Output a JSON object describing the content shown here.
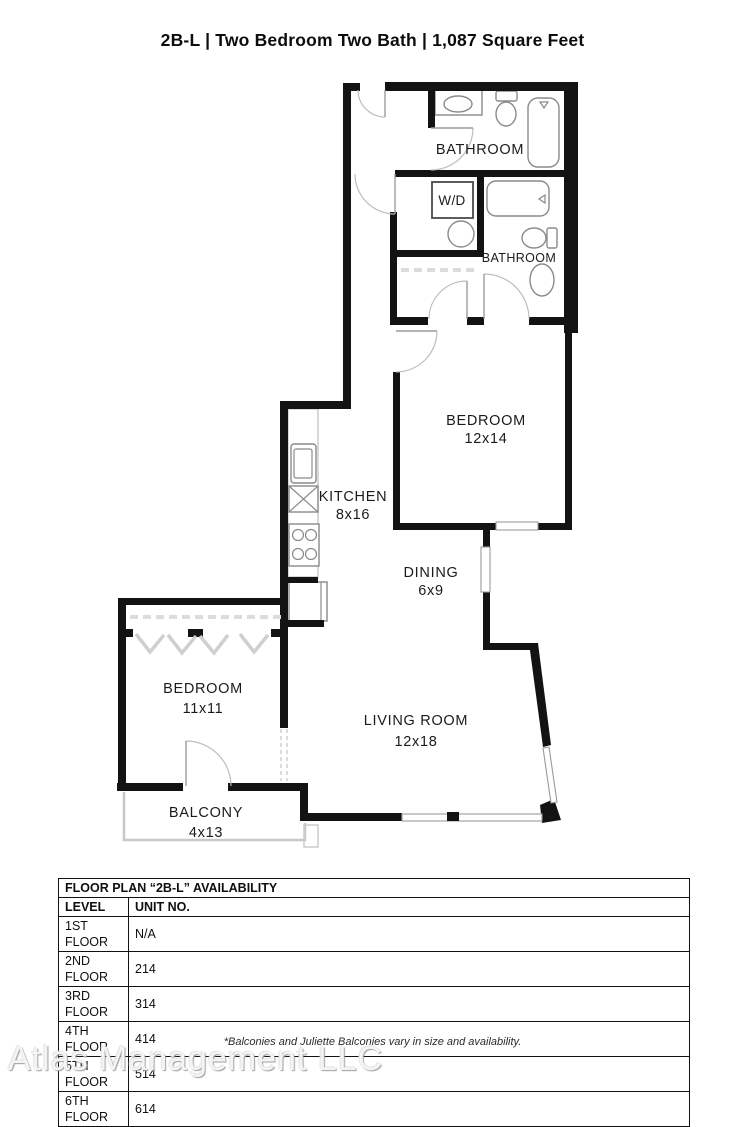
{
  "page": {
    "title": "2B-L | Two Bedroom Two Bath | 1,087 Square Feet",
    "footnote": "*Balconies and Juliette Balconies vary in size and availability.",
    "watermark": "Atlas Management LLC"
  },
  "floor_plan": {
    "rooms": {
      "bathroom_1": {
        "label": "BATHROOM"
      },
      "laundry": {
        "label": "W/D"
      },
      "bathroom_2": {
        "label": "BATHROOM"
      },
      "bedroom_1": {
        "label": "BEDROOM",
        "dims": "12x14"
      },
      "kitchen": {
        "label": "KITCHEN",
        "dims": "8x16"
      },
      "dining": {
        "label": "DINING",
        "dims": "6x9"
      },
      "bedroom_2": {
        "label": "BEDROOM",
        "dims": "11x11"
      },
      "living_room": {
        "label": "LIVING ROOM",
        "dims": "12x18"
      },
      "balcony": {
        "label": "BALCONY",
        "dims": "4x13"
      }
    }
  },
  "availability_table": {
    "title": "FLOOR PLAN “2B-L” AVAILABILITY",
    "columns": {
      "level": "LEVEL",
      "unit": "UNIT NO."
    },
    "rows": [
      {
        "level": "1ST FLOOR",
        "unit": "N/A"
      },
      {
        "level": "2ND FLOOR",
        "unit": "214"
      },
      {
        "level": "3RD FLOOR",
        "unit": "314"
      },
      {
        "level": "4TH FLOOR",
        "unit": "414"
      },
      {
        "level": "5TH FLOOR",
        "unit": "514"
      },
      {
        "level": "6TH FLOOR",
        "unit": "614"
      }
    ]
  }
}
